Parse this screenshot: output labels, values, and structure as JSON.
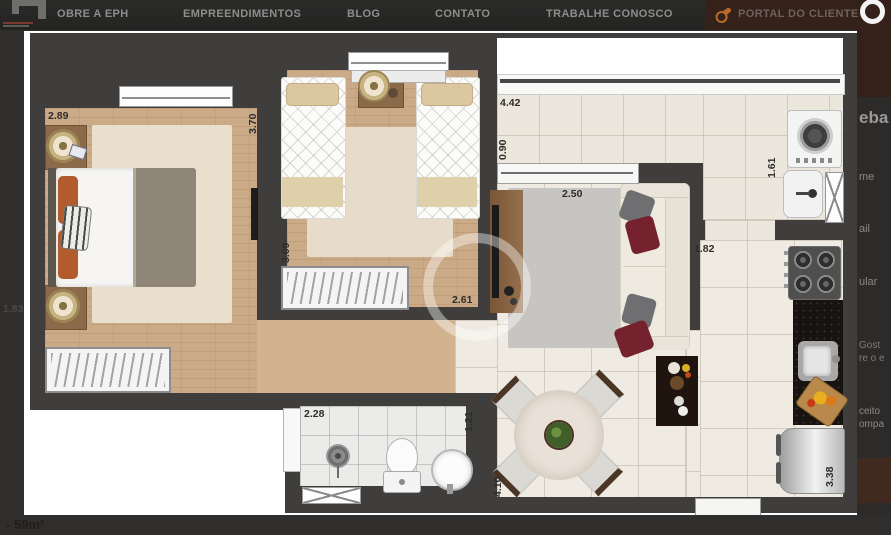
{
  "nav": {
    "items": [
      {
        "label": "OBRE A EPH"
      },
      {
        "label": "EMPREENDIMENTOS"
      },
      {
        "label": "BLOG"
      },
      {
        "label": "CONTATO"
      },
      {
        "label": "TRABALHE CONOSCO"
      },
      {
        "label": "PORTAL DO CLIENTE"
      }
    ]
  },
  "right_panel": {
    "title_fragment": "eba",
    "field_fragment_1": "me",
    "field_fragment_2": "ail",
    "field_fragment_3": "ular",
    "message_fragment_1": "Gost",
    "message_fragment_2": "re o e",
    "consent_fragment_1": "ceito",
    "consent_fragment_2": "ompa"
  },
  "bottom_bar": {
    "caption": "- 59m²"
  },
  "left_edge_label": "1.83",
  "floorplan": {
    "dims": {
      "bedroom1_width": "2.89",
      "bedroom1_depth": "3.70",
      "bedroom2_depth": "3.09",
      "bedroom2_width": "2.61",
      "balcony_length": "4.42",
      "balcony_depth": "0.90",
      "living_width": "2.50",
      "service_width": "1.61",
      "kitchen_width": "1.82",
      "bathroom_width": "2.28",
      "bathroom_depth": "1.21",
      "dining_length": "4.10",
      "kitchen_depth": "3.38"
    }
  },
  "colors": {
    "accent_orange": "#b96a2a",
    "brand_brown": "#33211a",
    "wall_gray": "#3f3e3d",
    "page_bg": "#2f2e2c"
  }
}
